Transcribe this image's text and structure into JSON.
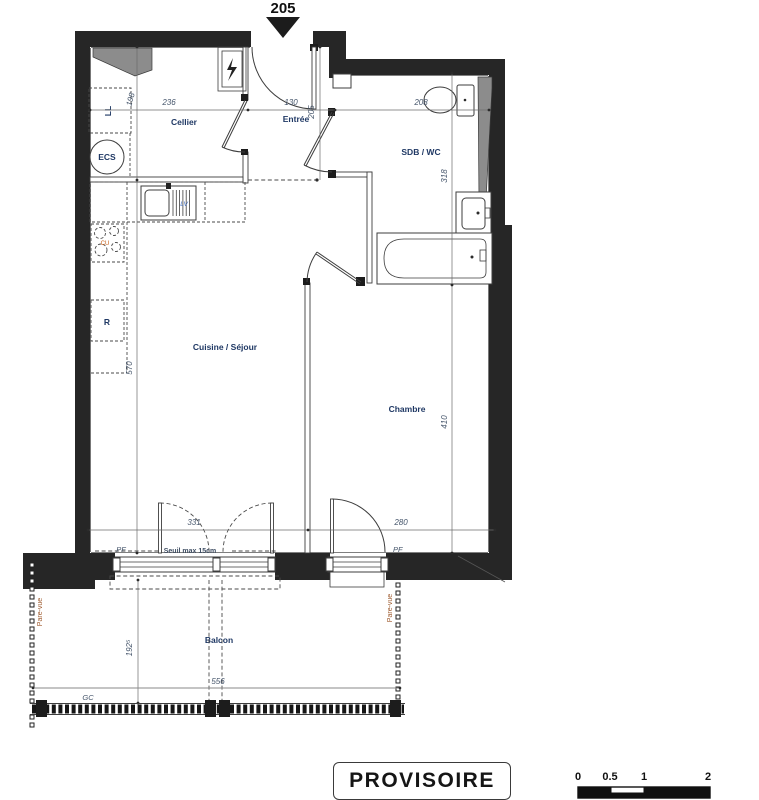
{
  "plan": {
    "lot_number": "205",
    "rooms": {
      "cellier": "Cellier",
      "entree": "Entrée",
      "sdb": "SDB / WC",
      "sejour": "Cuisine / Séjour",
      "chambre": "Chambre",
      "balcon": "Balcon"
    },
    "appliances": {
      "ll": "LL",
      "ecs": "ECS",
      "r": "R",
      "lv": "LV",
      "cu": "CU"
    },
    "dimensions": {
      "cellier_w": "236",
      "entree_w": "130",
      "sdb_w": "208",
      "cellier_h": "198",
      "entree_h": "205",
      "sdb_h": "318",
      "sejour_h": "570",
      "chambre_h": "410",
      "sejour_w": "331",
      "chambre_w": "280",
      "balcon_w": "556",
      "balcon_d": "192⁵"
    },
    "annotations": {
      "seuil": "Seuil max 15cm",
      "pf_left": "PF",
      "pf_right": "PF",
      "gc": "GC",
      "pare_vue_left": "Pare-vue",
      "pare_vue_right": "Pare-vue"
    }
  },
  "stamp": {
    "label": "PROVISOIRE"
  },
  "scale_bar": {
    "ticks": [
      "0",
      "0.5",
      "1",
      "2"
    ]
  },
  "colors": {
    "wall": "#262626",
    "room_label": "#1f3864",
    "dimension": "#44546a",
    "pare_vue": "#9e5a2d",
    "appliance_lv": "#4472c4",
    "appliance_cu": "#c55a11"
  }
}
